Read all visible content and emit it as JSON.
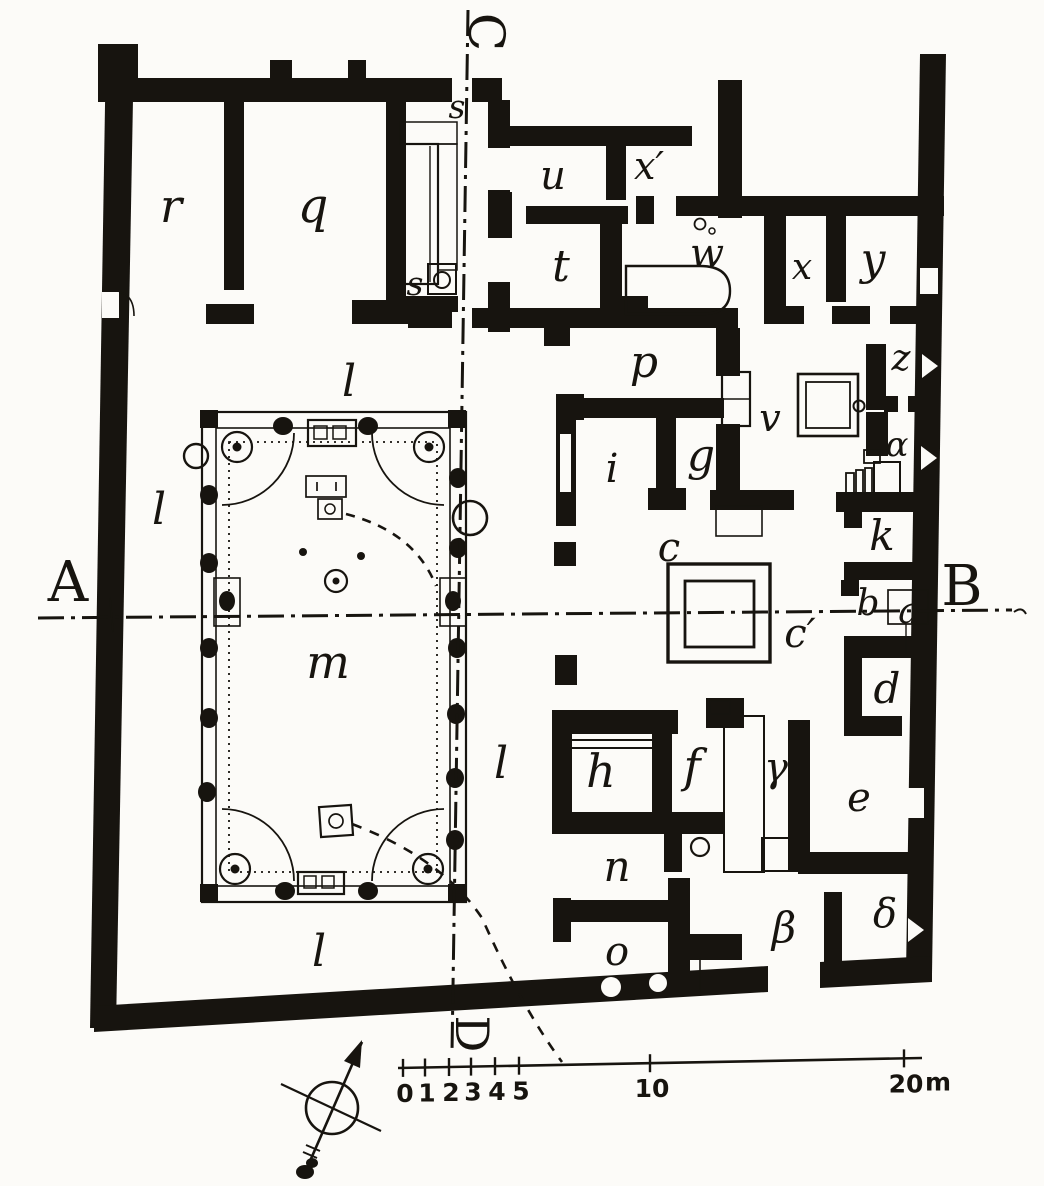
{
  "figure": {
    "kind": "scanned architectural floor plan (engraving style)",
    "subject": "ground plan of a Roman house with peristyle garden, atrium and numbered rooms",
    "paper_color": "#fcfbf8",
    "ink_color": "#17140f"
  },
  "section_lines": {
    "horizontal": {
      "from_label": "A",
      "to_label": "B"
    },
    "vertical": {
      "from_label": "C",
      "to_label": "D"
    },
    "style": "dash-dot"
  },
  "labels": [
    {
      "id": "section-marker-a",
      "t": "A",
      "x": 68,
      "y": 601,
      "s": 56,
      "f": "roman"
    },
    {
      "id": "section-marker-b",
      "t": "B",
      "x": 962,
      "y": 605,
      "s": 56,
      "f": "roman"
    },
    {
      "id": "section-marker-c",
      "t": "C",
      "x": 469,
      "y": 32,
      "s": 50,
      "f": "roman",
      "r": 90
    },
    {
      "id": "section-marker-d",
      "t": "D",
      "x": 456,
      "y": 1034,
      "s": 46,
      "f": "roman",
      "r": 90
    },
    {
      "id": "room-r",
      "t": "r",
      "x": 171,
      "y": 222,
      "s": 46
    },
    {
      "id": "room-q",
      "t": "q",
      "x": 313,
      "y": 222,
      "s": 48
    },
    {
      "id": "room-s-upper",
      "t": "s",
      "x": 457,
      "y": 118,
      "s": 33
    },
    {
      "id": "room-s-lower",
      "t": "s",
      "x": 415,
      "y": 295,
      "s": 33
    },
    {
      "id": "room-u",
      "t": "u",
      "x": 553,
      "y": 189,
      "s": 40
    },
    {
      "id": "room-x-prime",
      "t": "x′",
      "x": 649,
      "y": 179,
      "s": 38
    },
    {
      "id": "room-t",
      "t": "t",
      "x": 561,
      "y": 281,
      "s": 44
    },
    {
      "id": "room-w",
      "t": "w",
      "x": 707,
      "y": 267,
      "s": 40
    },
    {
      "id": "room-x",
      "t": "x",
      "x": 802,
      "y": 279,
      "s": 36
    },
    {
      "id": "room-y",
      "t": "y",
      "x": 873,
      "y": 274,
      "s": 44
    },
    {
      "id": "corridor-p",
      "t": "p",
      "x": 644,
      "y": 377,
      "s": 44
    },
    {
      "id": "door-v",
      "t": "v",
      "x": 770,
      "y": 431,
      "s": 38
    },
    {
      "id": "room-z",
      "t": "z",
      "x": 901,
      "y": 370,
      "s": 36
    },
    {
      "id": "room-alpha",
      "t": "α",
      "x": 897,
      "y": 456,
      "s": 34
    },
    {
      "id": "room-i",
      "t": "i",
      "x": 612,
      "y": 482,
      "s": 40
    },
    {
      "id": "room-g",
      "t": "g",
      "x": 701,
      "y": 470,
      "s": 44
    },
    {
      "id": "atrium-c",
      "t": "c",
      "x": 669,
      "y": 561,
      "s": 40
    },
    {
      "id": "room-k",
      "t": "k",
      "x": 882,
      "y": 550,
      "s": 42
    },
    {
      "id": "room-b",
      "t": "b",
      "x": 868,
      "y": 615,
      "s": 36
    },
    {
      "id": "entrance-a",
      "t": "a",
      "x": 909,
      "y": 623,
      "s": 36
    },
    {
      "id": "label-c-prime",
      "t": "c′",
      "x": 800,
      "y": 647,
      "s": 40
    },
    {
      "id": "room-d",
      "t": "d",
      "x": 887,
      "y": 703,
      "s": 42
    },
    {
      "id": "room-e",
      "t": "e",
      "x": 859,
      "y": 811,
      "s": 40
    },
    {
      "id": "room-h",
      "t": "h",
      "x": 601,
      "y": 787,
      "s": 46
    },
    {
      "id": "room-f",
      "t": "f",
      "x": 692,
      "y": 782,
      "s": 46
    },
    {
      "id": "stair-gamma",
      "t": "γ",
      "x": 776,
      "y": 781,
      "s": 40
    },
    {
      "id": "room-n",
      "t": "n",
      "x": 617,
      "y": 881,
      "s": 42
    },
    {
      "id": "passage-beta",
      "t": "β",
      "x": 784,
      "y": 942,
      "s": 42
    },
    {
      "id": "room-delta",
      "t": "δ",
      "x": 885,
      "y": 927,
      "s": 40
    },
    {
      "id": "room-o",
      "t": "o",
      "x": 617,
      "y": 965,
      "s": 40
    },
    {
      "id": "corridor-l-top",
      "t": "l",
      "x": 349,
      "y": 396,
      "s": 44
    },
    {
      "id": "corridor-l-left",
      "t": "l",
      "x": 159,
      "y": 524,
      "s": 44
    },
    {
      "id": "corridor-l-right",
      "t": "l",
      "x": 501,
      "y": 778,
      "s": 44
    },
    {
      "id": "corridor-l-bottom",
      "t": "l",
      "x": 319,
      "y": 966,
      "s": 44
    },
    {
      "id": "peristyle-m",
      "t": "m",
      "x": 328,
      "y": 678,
      "s": 46
    }
  ],
  "scale_bar": {
    "unit": "m",
    "unit_x": 938,
    "ticks": [
      {
        "label": "0",
        "x": 403
      },
      {
        "label": "1",
        "x": 425
      },
      {
        "label": "2",
        "x": 449
      },
      {
        "label": "3",
        "x": 471
      },
      {
        "label": "4",
        "x": 495
      },
      {
        "label": "5",
        "x": 519
      },
      {
        "label": "10",
        "x": 650
      },
      {
        "label": "20",
        "x": 904
      }
    ]
  },
  "icons": {
    "compass": "north-arrow-compass-rose"
  }
}
